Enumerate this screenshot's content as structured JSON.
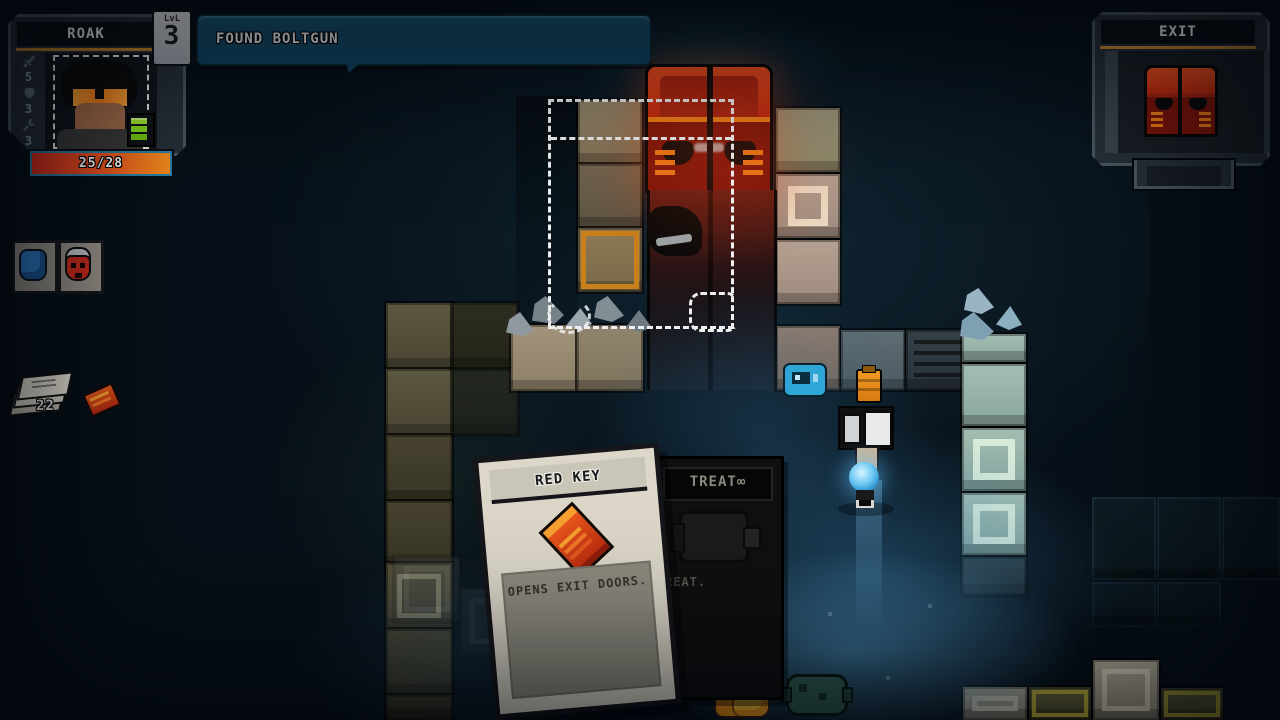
{
  "hud": {
    "player_panel": {
      "name": "ROAK",
      "level_label": "LvL",
      "level_value": "3",
      "health": "25/28",
      "stats": [
        {
          "icon": "sword-icon",
          "value": "5"
        },
        {
          "icon": "shield-icon",
          "value": "3"
        },
        {
          "icon": "wrench-icon",
          "value": "3"
        }
      ]
    },
    "notification": {
      "text": "FOUND BOLTGUN"
    },
    "exit_panel": {
      "title": "EXIT",
      "icon": "red-door-icon"
    },
    "inventory": [
      {
        "icon": "blue-armor-icon"
      },
      {
        "icon": "red-mask-icon"
      }
    ],
    "pickups": {
      "scrap_count": "22",
      "scrap_icon": "scrap-papers-icon",
      "key_icon": "red-keycard-icon"
    }
  },
  "cards": {
    "red_key": {
      "title": "RED KEY",
      "description": "OPENS EXIT DOORS.",
      "icon": "red-keycard-icon"
    },
    "retreat": {
      "title_visible": "TREAT∞",
      "description_visible": "REAT.",
      "icon": "grenade-icon"
    }
  },
  "colors": {
    "accent_orange": "#c8862e",
    "hud_panel": "#262f38",
    "notification_blue": "#175070",
    "health_red": "#d92f1e",
    "health_orange": "#f08c1c",
    "door_red": "#e6391b",
    "lit_floor_blue": "#3f84ad",
    "card_front": "#dcd7c9",
    "battery_green": "#86d81e"
  }
}
